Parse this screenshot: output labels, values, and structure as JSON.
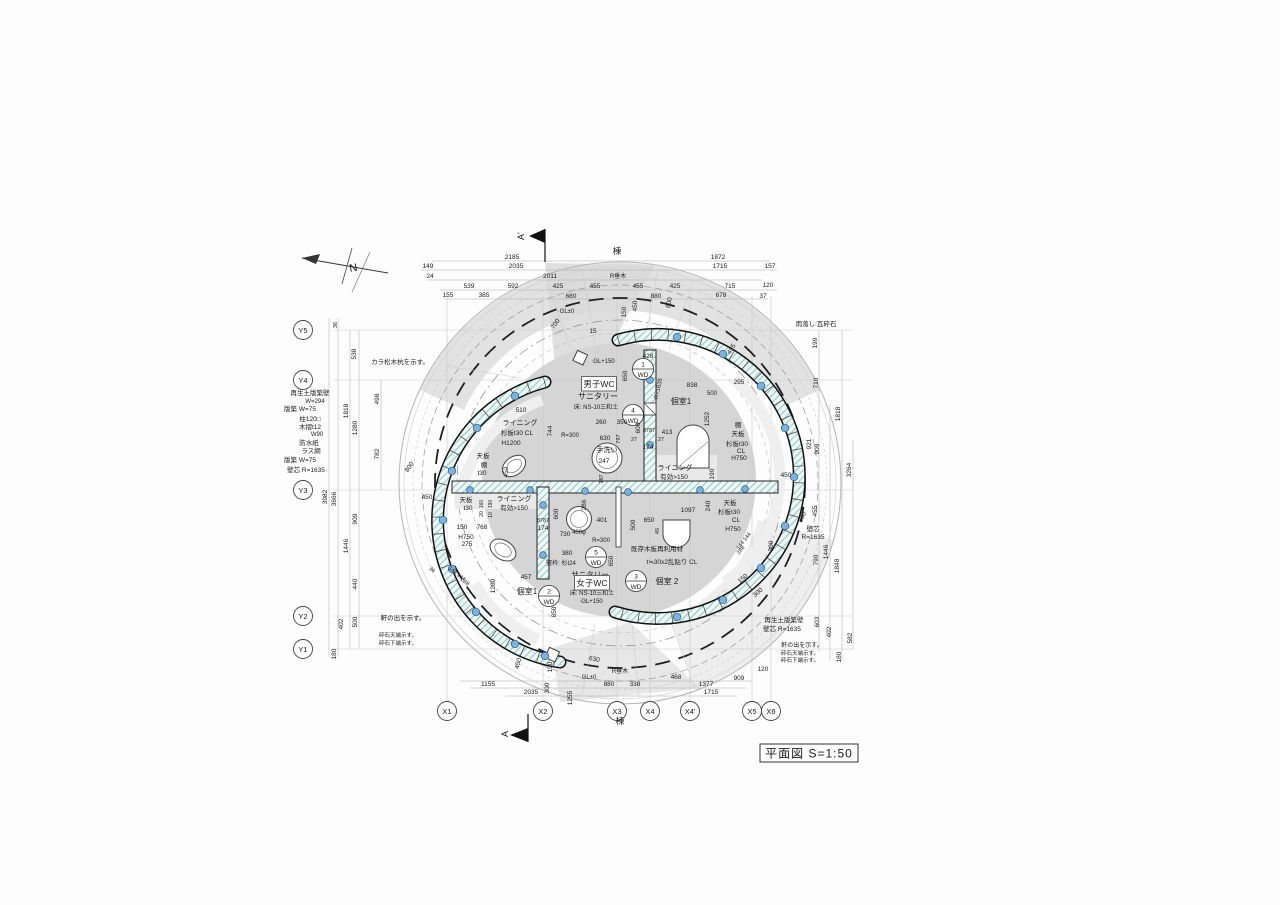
{
  "title": {
    "text": "平面図  S=1:50"
  },
  "north_label": "N",
  "wd_label": "WD",
  "section": {
    "top": "A'",
    "bottom": "A"
  },
  "colors": {
    "wall_hatch": "#6fbdb6",
    "post_dot": "#7ab3e0",
    "shade": "#dbdbdb",
    "floor": "#d5d5d5",
    "line": "#1c1c1c"
  },
  "grid": {
    "x": [
      {
        "id": "X1",
        "px": 447
      },
      {
        "id": "X2",
        "px": 543
      },
      {
        "id": "X3",
        "px": 617
      },
      {
        "id": "X4",
        "px": 650
      },
      {
        "id": "X4'",
        "px": 690
      },
      {
        "id": "X5",
        "px": 752
      },
      {
        "id": "X6",
        "px": 771
      }
    ],
    "y": [
      {
        "id": "Y5",
        "py": 330
      },
      {
        "id": "Y4",
        "py": 380
      },
      {
        "id": "Y3",
        "py": 490
      },
      {
        "id": "Y2",
        "py": 616
      },
      {
        "id": "Y1",
        "py": 649
      }
    ]
  },
  "wd_marks": [
    {
      "num": "1",
      "x": 643,
      "y": 369
    },
    {
      "num": "4",
      "x": 633,
      "y": 415
    },
    {
      "num": "5",
      "x": 596,
      "y": 557
    },
    {
      "num": "2",
      "x": 549,
      "y": 596
    },
    {
      "num": "3",
      "x": 636,
      "y": 581
    }
  ],
  "labels": [
    {
      "t": "2185",
      "x": 512,
      "y": 259
    },
    {
      "t": "棟",
      "x": 617,
      "y": 254,
      "s": 8.5
    },
    {
      "t": "1872",
      "x": 718,
      "y": 259
    },
    {
      "t": "149",
      "x": 428,
      "y": 268
    },
    {
      "t": "2035",
      "x": 516,
      "y": 268
    },
    {
      "t": "1715",
      "x": 720,
      "y": 268
    },
    {
      "t": "157",
      "x": 770,
      "y": 268
    },
    {
      "t": "24",
      "x": 430,
      "y": 278
    },
    {
      "t": "2011",
      "x": 550,
      "y": 278
    },
    {
      "t": "R垂木",
      "x": 618,
      "y": 278,
      "s": 6
    },
    {
      "t": "539",
      "x": 469,
      "y": 288
    },
    {
      "t": "592",
      "x": 513,
      "y": 288
    },
    {
      "t": "425",
      "x": 558,
      "y": 288
    },
    {
      "t": "455",
      "x": 595,
      "y": 288
    },
    {
      "t": "455",
      "x": 638,
      "y": 288
    },
    {
      "t": "425",
      "x": 675,
      "y": 288
    },
    {
      "t": "715",
      "x": 730,
      "y": 288
    },
    {
      "t": "120",
      "x": 768,
      "y": 287
    },
    {
      "t": "155",
      "x": 448,
      "y": 297
    },
    {
      "t": "385",
      "x": 484,
      "y": 297
    },
    {
      "t": "680",
      "x": 571,
      "y": 298
    },
    {
      "t": "880",
      "x": 656,
      "y": 298
    },
    {
      "t": "678",
      "x": 721,
      "y": 297
    },
    {
      "t": "37",
      "x": 763,
      "y": 298
    },
    {
      "t": "800",
      "x": 671,
      "y": 303,
      "r": -80
    },
    {
      "t": "·GL±0",
      "x": 566,
      "y": 313,
      "s": 6
    },
    {
      "t": "700",
      "x": 557,
      "y": 325,
      "r": -55
    },
    {
      "t": "15",
      "x": 593,
      "y": 333
    },
    {
      "t": "150",
      "x": 626,
      "y": 312,
      "r": -90
    },
    {
      "t": "450",
      "x": 637,
      "y": 306,
      "r": -90
    },
    {
      "t": "·GL+150",
      "x": 603,
      "y": 363,
      "s": 6
    },
    {
      "t": "428",
      "x": 648,
      "y": 358
    },
    {
      "t": "650",
      "x": 627,
      "y": 376,
      "r": -90
    },
    {
      "t": "R=1635",
      "x": 660,
      "y": 389,
      "r": -78,
      "s": 6
    },
    {
      "t": "495",
      "x": 733,
      "y": 350,
      "r": -58
    },
    {
      "t": "295",
      "x": 739,
      "y": 384
    },
    {
      "t": "838",
      "x": 692,
      "y": 387
    },
    {
      "t": "500",
      "x": 712,
      "y": 395,
      "s": 6
    },
    {
      "t": "個室1",
      "x": 681,
      "y": 404,
      "s": 8
    },
    {
      "t": "1252",
      "x": 709,
      "y": 419,
      "r": -90
    },
    {
      "t": "棚",
      "x": 738,
      "y": 427
    },
    {
      "t": "天板",
      "x": 738,
      "y": 436
    },
    {
      "t": "杉板t30",
      "x": 737,
      "y": 446
    },
    {
      "t": "CL",
      "x": 741,
      "y": 453
    },
    {
      "t": "H750",
      "x": 739,
      "y": 460
    },
    {
      "t": "男子WC",
      "x": 599,
      "y": 387,
      "s": 8.5,
      "b": 1
    },
    {
      "t": "サニタリー",
      "x": 598,
      "y": 399,
      "s": 8
    },
    {
      "t": "床: NS-10三和土",
      "x": 596,
      "y": 409,
      "s": 6
    },
    {
      "t": "510",
      "x": 521,
      "y": 412
    },
    {
      "t": "ライニング",
      "x": 520,
      "y": 425,
      "s": 7
    },
    {
      "t": "杉板t30 CL",
      "x": 517,
      "y": 435,
      "s": 6.5
    },
    {
      "t": "H1200",
      "x": 511,
      "y": 445
    },
    {
      "t": "天板",
      "x": 483,
      "y": 458
    },
    {
      "t": "棚",
      "x": 484,
      "y": 467
    },
    {
      "t": "t30",
      "x": 482,
      "y": 475
    },
    {
      "t": "452",
      "x": 508,
      "y": 472,
      "r": -90
    },
    {
      "t": "744",
      "x": 552,
      "y": 431,
      "r": -90
    },
    {
      "t": "R=300",
      "x": 570,
      "y": 437,
      "s": 6
    },
    {
      "t": "260",
      "x": 601,
      "y": 424
    },
    {
      "t": "350",
      "x": 622,
      "y": 424
    },
    {
      "t": "600",
      "x": 640,
      "y": 428,
      "r": -90
    },
    {
      "t": "8787",
      "x": 649,
      "y": 432,
      "s": 5.5
    },
    {
      "t": "413",
      "x": 667,
      "y": 434
    },
    {
      "t": "27",
      "x": 634,
      "y": 441,
      "s": 5.5
    },
    {
      "t": "27",
      "x": 661,
      "y": 441,
      "s": 5.5
    },
    {
      "t": "174",
      "x": 648,
      "y": 449
    },
    {
      "t": "630",
      "x": 605,
      "y": 440
    },
    {
      "t": "797",
      "x": 620,
      "y": 439,
      "r": -90,
      "s": 5.5
    },
    {
      "t": "手洗い",
      "x": 607,
      "y": 452,
      "s": 7
    },
    {
      "t": "247",
      "x": 604,
      "y": 463
    },
    {
      "t": "187",
      "x": 603,
      "y": 479,
      "r": -90,
      "s": 5.5
    },
    {
      "t": "450",
      "x": 427,
      "y": 499
    },
    {
      "t": "天板",
      "x": 466,
      "y": 502
    },
    {
      "t": "t30",
      "x": 468,
      "y": 510
    },
    {
      "t": "ライニング",
      "x": 514,
      "y": 501,
      "s": 7
    },
    {
      "t": "有効>150",
      "x": 514,
      "y": 510,
      "s": 6.5
    },
    {
      "t": "160",
      "x": 483,
      "y": 504,
      "r": -90,
      "s": 5
    },
    {
      "t": "20",
      "x": 483,
      "y": 514,
      "r": -90,
      "s": 5
    },
    {
      "t": "190",
      "x": 492,
      "y": 504,
      "r": -90,
      "s": 5
    },
    {
      "t": "10",
      "x": 492,
      "y": 515,
      "r": -90,
      "s": 5
    },
    {
      "t": "150",
      "x": 462,
      "y": 529
    },
    {
      "t": "768",
      "x": 482,
      "y": 529
    },
    {
      "t": "H750",
      "x": 466,
      "y": 539
    },
    {
      "t": "275",
      "x": 467,
      "y": 546
    },
    {
      "t": "144 144",
      "x": 456,
      "y": 575,
      "r": 38,
      "s": 5.5
    },
    {
      "t": "288",
      "x": 464,
      "y": 583,
      "r": 38,
      "s": 5.5
    },
    {
      "t": "36",
      "x": 431,
      "y": 571,
      "r": 38,
      "s": 5.5
    },
    {
      "t": "8787",
      "x": 543,
      "y": 522,
      "s": 5.5
    },
    {
      "t": "174",
      "x": 543,
      "y": 530
    },
    {
      "t": "600",
      "x": 558,
      "y": 514,
      "r": -90
    },
    {
      "t": "286",
      "x": 586,
      "y": 505,
      "r": -90
    },
    {
      "t": "401",
      "x": 602,
      "y": 522
    },
    {
      "t": "730",
      "x": 565,
      "y": 536
    },
    {
      "t": "400φ",
      "x": 579,
      "y": 534,
      "s": 6
    },
    {
      "t": "R=300",
      "x": 601,
      "y": 542,
      "s": 6
    },
    {
      "t": "380",
      "x": 567,
      "y": 555
    },
    {
      "t": "竪枠: 杉t24",
      "x": 561,
      "y": 565,
      "s": 6
    },
    {
      "t": "457",
      "x": 526,
      "y": 579
    },
    {
      "t": "1200",
      "x": 495,
      "y": 586,
      "r": -90
    },
    {
      "t": "個室1",
      "x": 527,
      "y": 594,
      "s": 8
    },
    {
      "t": "サニタリー",
      "x": 590,
      "y": 577,
      "s": 7.5
    },
    {
      "t": "女子WC",
      "x": 592,
      "y": 586,
      "s": 8.5,
      "b": 1
    },
    {
      "t": "床: NS-10三和土",
      "x": 592,
      "y": 595,
      "s": 6
    },
    {
      "t": "·GL+150",
      "x": 591,
      "y": 603,
      "s": 6
    },
    {
      "t": "650",
      "x": 556,
      "y": 612,
      "r": -90
    },
    {
      "t": "650",
      "x": 613,
      "y": 561,
      "r": -90
    },
    {
      "t": "個室 2",
      "x": 667,
      "y": 584,
      "s": 8
    },
    {
      "t": "既存木板再利用材",
      "x": 657,
      "y": 551,
      "s": 6.5
    },
    {
      "t": "t≒30x2乱貼り CL",
      "x": 672,
      "y": 564,
      "s": 6.5
    },
    {
      "t": "500",
      "x": 635,
      "y": 525,
      "r": -90
    },
    {
      "t": "650",
      "x": 649,
      "y": 522
    },
    {
      "t": "45",
      "x": 659,
      "y": 531,
      "r": -90,
      "s": 5.5
    },
    {
      "t": "1097",
      "x": 688,
      "y": 512
    },
    {
      "t": "240",
      "x": 710,
      "y": 506,
      "r": -90
    },
    {
      "t": "天板",
      "x": 730,
      "y": 505
    },
    {
      "t": "杉板t30",
      "x": 729,
      "y": 514
    },
    {
      "t": "CL",
      "x": 736,
      "y": 522
    },
    {
      "t": "H750",
      "x": 733,
      "y": 531
    },
    {
      "t": "144 144",
      "x": 745,
      "y": 542,
      "r": -52,
      "s": 5.5
    },
    {
      "t": "288",
      "x": 742,
      "y": 551,
      "r": -52,
      "s": 5.5
    },
    {
      "t": "150",
      "x": 744,
      "y": 580,
      "r": -40
    },
    {
      "t": "300",
      "x": 759,
      "y": 594,
      "r": -40
    },
    {
      "t": "ライニング",
      "x": 675,
      "y": 470,
      "s": 7
    },
    {
      "t": "有効>150",
      "x": 674,
      "y": 479,
      "s": 6.5
    },
    {
      "t": "190",
      "x": 714,
      "y": 474,
      "r": -90
    },
    {
      "t": "450",
      "x": 786,
      "y": 477
    },
    {
      "t": "300",
      "x": 773,
      "y": 546,
      "r": -90
    },
    {
      "t": "雨落し:瓦砕石",
      "x": 816,
      "y": 326,
      "s": 6.5
    },
    {
      "t": "199",
      "x": 817,
      "y": 343,
      "r": -90
    },
    {
      "t": "710",
      "x": 818,
      "y": 383,
      "r": -90
    },
    {
      "t": "1818",
      "x": 840,
      "y": 414,
      "r": -90
    },
    {
      "t": "921",
      "x": 811,
      "y": 444,
      "r": -90
    },
    {
      "t": "909",
      "x": 819,
      "y": 449,
      "r": -90
    },
    {
      "t": "3264",
      "x": 851,
      "y": 470,
      "r": -90
    },
    {
      "t": "455",
      "x": 817,
      "y": 511,
      "r": -90
    },
    {
      "t": "800",
      "x": 804,
      "y": 518,
      "r": -65
    },
    {
      "t": "壁芯",
      "x": 813,
      "y": 531,
      "s": 6.5
    },
    {
      "t": "R=1635",
      "x": 813,
      "y": 539,
      "s": 6.5
    },
    {
      "t": "1446",
      "x": 828,
      "y": 552,
      "r": -90
    },
    {
      "t": "790",
      "x": 818,
      "y": 560,
      "r": -90
    },
    {
      "t": "1848",
      "x": 839,
      "y": 566,
      "r": -90
    },
    {
      "t": "再生土版築壁",
      "x": 784,
      "y": 622,
      "s": 6.5
    },
    {
      "t": "壁芯  R=1635",
      "x": 782,
      "y": 631,
      "s": 6.5
    },
    {
      "t": "603",
      "x": 819,
      "y": 622,
      "r": -90
    },
    {
      "t": "402",
      "x": 831,
      "y": 632,
      "r": -90
    },
    {
      "t": "582",
      "x": 852,
      "y": 638,
      "r": -90
    },
    {
      "t": "軒の出を示す。",
      "x": 802,
      "y": 647,
      "s": 6
    },
    {
      "t": "砕石天端示す。",
      "x": 800,
      "y": 655,
      "s": 5.5
    },
    {
      "t": "砕石下端示す。",
      "x": 800,
      "y": 662,
      "s": 5.5
    },
    {
      "t": "180",
      "x": 841,
      "y": 657,
      "r": -90
    },
    {
      "t": "120",
      "x": 763,
      "y": 671
    },
    {
      "t": "カラ松木杭を示す。",
      "x": 400,
      "y": 364,
      "s": 6.5
    },
    {
      "t": "36",
      "x": 337,
      "y": 325,
      "r": -90,
      "s": 5.5
    },
    {
      "t": "538",
      "x": 356,
      "y": 354,
      "r": -90
    },
    {
      "t": "498",
      "x": 379,
      "y": 399,
      "r": -90
    },
    {
      "t": "1818",
      "x": 348,
      "y": 411,
      "r": -90
    },
    {
      "t": "1280",
      "x": 357,
      "y": 428,
      "r": -90
    },
    {
      "t": "782",
      "x": 379,
      "y": 454,
      "r": -90
    },
    {
      "t": "800",
      "x": 411,
      "y": 468,
      "r": -55
    },
    {
      "t": "3982",
      "x": 327,
      "y": 497,
      "r": -90
    },
    {
      "t": "3666",
      "x": 336,
      "y": 499,
      "r": -90
    },
    {
      "t": "909",
      "x": 357,
      "y": 519,
      "r": -90
    },
    {
      "t": "1446",
      "x": 348,
      "y": 546,
      "r": -90
    },
    {
      "t": "440",
      "x": 357,
      "y": 584,
      "r": -90
    },
    {
      "t": "402",
      "x": 343,
      "y": 624,
      "r": -90
    },
    {
      "t": "500",
      "x": 357,
      "y": 622,
      "r": -90
    },
    {
      "t": "180",
      "x": 336,
      "y": 654,
      "r": -90
    },
    {
      "t": "再生土版築壁",
      "x": 310,
      "y": 395,
      "s": 6.5
    },
    {
      "t": "W=294",
      "x": 315,
      "y": 403,
      "s": 6
    },
    {
      "t": "版築  W=75",
      "x": 300,
      "y": 411,
      "s": 6.5
    },
    {
      "t": "柱120□",
      "x": 310,
      "y": 421,
      "s": 6.5
    },
    {
      "t": "木摺t12",
      "x": 310,
      "y": 429,
      "s": 6.5
    },
    {
      "t": "W90",
      "x": 317,
      "y": 436,
      "s": 6
    },
    {
      "t": "防水紙",
      "x": 309,
      "y": 445,
      "s": 6.5
    },
    {
      "t": "ラス網",
      "x": 311,
      "y": 453,
      "s": 6.5
    },
    {
      "t": "版築  W=75",
      "x": 300,
      "y": 462,
      "s": 6.5
    },
    {
      "t": "壁芯  R=1635",
      "x": 306,
      "y": 472,
      "s": 6.5
    },
    {
      "t": "軒の出を示す。",
      "x": 403,
      "y": 620,
      "s": 6.5
    },
    {
      "t": "砕石天端示す。",
      "x": 398,
      "y": 637,
      "s": 5.5
    },
    {
      "t": "砕石下端示す。",
      "x": 398,
      "y": 645,
      "s": 5.5
    },
    {
      "t": "450",
      "x": 520,
      "y": 664,
      "r": -75
    },
    {
      "t": "190",
      "x": 552,
      "y": 667,
      "r": -90
    },
    {
      "t": "630",
      "x": 594,
      "y": 661,
      "r": 12
    },
    {
      "t": "R垂木",
      "x": 620,
      "y": 673,
      "s": 6
    },
    {
      "t": "·GL±0",
      "x": 588,
      "y": 679,
      "s": 6
    },
    {
      "t": "1155",
      "x": 488,
      "y": 686
    },
    {
      "t": "880",
      "x": 609,
      "y": 686
    },
    {
      "t": "338",
      "x": 635,
      "y": 686
    },
    {
      "t": "468",
      "x": 676,
      "y": 679
    },
    {
      "t": "1377",
      "x": 706,
      "y": 686
    },
    {
      "t": "909",
      "x": 739,
      "y": 680
    },
    {
      "t": "2035",
      "x": 531,
      "y": 694
    },
    {
      "t": "1715",
      "x": 711,
      "y": 694
    },
    {
      "t": "300",
      "x": 549,
      "y": 688,
      "r": -90
    },
    {
      "t": "1255",
      "x": 572,
      "y": 698,
      "r": -90
    },
    {
      "t": "棟",
      "x": 620,
      "y": 724,
      "s": 8.5
    }
  ]
}
